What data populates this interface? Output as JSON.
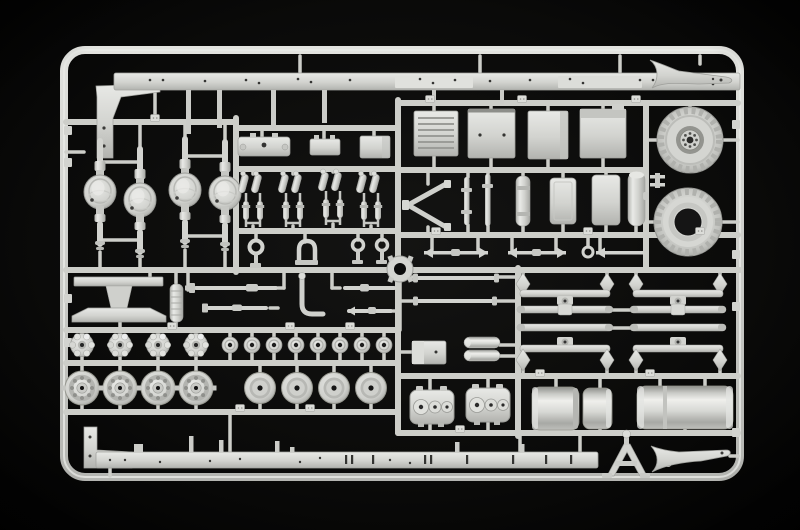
{
  "scene": {
    "type": "photograph",
    "description": "Light grey injection-moulded model kit sprue holding truck chassis parts, photographed on a black background",
    "background_color": "#050505",
    "plastic_color": "#d6d7d3",
    "plastic_highlight": "#eaebe8",
    "plastic_shadow": "#8b8c88"
  },
  "labels": {
    "sprue_frame": "rounded rectangular sprue frame",
    "chassis_rail_top": "truck chassis side rail (top)",
    "chassis_rail_bottom": "truck chassis side rail (bottom)",
    "axle_housings": "four drive axle housings with differential bulges",
    "equipment_panels": "four equipment box panels (one louvered)",
    "tire_with_hub": "tire with bolted wheel hub",
    "tire_open_center": "tire with open centre",
    "tow_fork_top": "forked towing arm (top right)",
    "tow_fork_bottom": "forked towing arm (bottom right)",
    "shock_absorbers": "four clusters of shock absorbers and brake chambers",
    "crossmember": "I-beam crossmember",
    "air_filter": "ribbed cylindrical air filter",
    "drive_shafts": "drive shafts with universal joints",
    "tie_rods": "tie rods and steering links with forked ends",
    "sprue_ring": "central sprue locating ring",
    "wheel_hubs": "knobbed wheel hub row",
    "hub_discs": "row of eight small hub discs",
    "hub_drums": "four detailed brake drum hubs",
    "road_wheels": "four plain wheel drums",
    "suspension_bogies": "two walking-beam suspension sets with leaf springs",
    "transfer_cases": "two transfer case halves with round bosses",
    "battery_box": "battery box",
    "air_tanks": "paired compressed air tanks",
    "fuel_tank_split": "two-piece cylindrical fuel tank",
    "fuel_tank_long": "long cylindrical fuel tank",
    "a_frame": "A-frame support bracket",
    "exhaust_pipe": "exhaust elbow pipe",
    "shackles": "eyelets and D-shackle",
    "muffler": "muffler and side reservoirs",
    "v_bracket": "chevron bracket"
  },
  "counts": {
    "axle_housings": 4,
    "tires": 2,
    "equipment_panels": 4,
    "shock_absorber_clusters": 4,
    "wheel_hubs": 4,
    "hub_discs": 8,
    "brake_drum_hubs": 4,
    "plain_wheel_drums": 4,
    "suspension_assemblies": 2,
    "transfer_cases": 2,
    "fuel_tanks": 2,
    "tow_forks": 2
  },
  "palette": {
    "runner": "#cdcec9",
    "base": "#d6d7d3",
    "light": "#eaebe8",
    "mid": "#c2c3bf",
    "dark": "#a5a6a2",
    "deep": "#8b8c88",
    "hole": "#141414",
    "background": "#050505"
  }
}
